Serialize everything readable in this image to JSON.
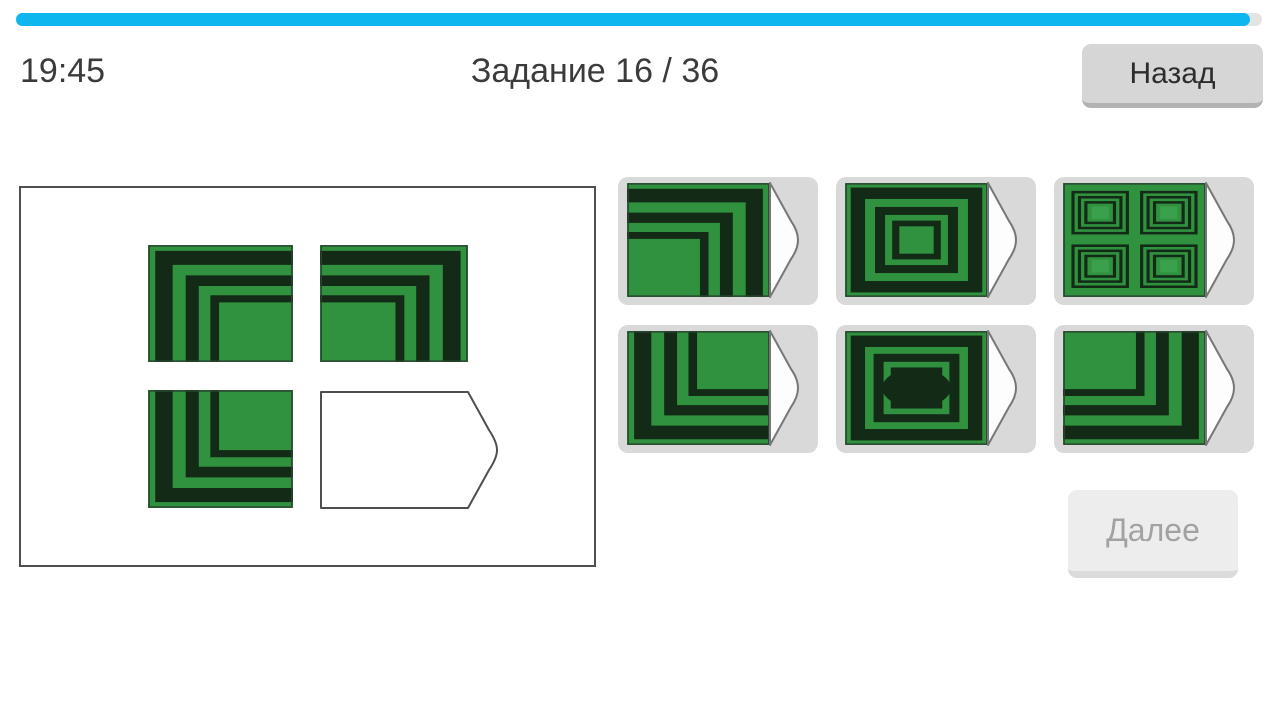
{
  "progress": {
    "percent_filled": 99,
    "fill_color": "#0db6ef",
    "track_color": "#e4e4e4"
  },
  "header": {
    "timer": "19:45",
    "title": "Задание 16 / 36"
  },
  "buttons": {
    "back": "Назад",
    "next": "Далее"
  },
  "palette": {
    "green": "#30913f",
    "green_light": "#3aa04b",
    "dark": "#122a16",
    "tile_outline": "#2a4630",
    "slot_outline": "#4f4f4f",
    "card_bg": "#d9d9d9"
  },
  "board": {
    "tiles": [
      {
        "cell": "top-left",
        "pattern": "corner-top-left"
      },
      {
        "cell": "top-right",
        "pattern": "corner-top-right"
      },
      {
        "cell": "bottom-left",
        "pattern": "corner-bottom-left"
      },
      {
        "cell": "bottom-right",
        "pattern": "empty-slot"
      }
    ],
    "bands": [
      [
        5,
        17
      ],
      [
        26,
        35
      ],
      [
        43,
        49
      ]
    ]
  },
  "options": [
    {
      "position": 1,
      "pattern": "corner-top-right"
    },
    {
      "position": 2,
      "pattern": "concentric-rects"
    },
    {
      "position": 3,
      "pattern": "quad-concentric-rects"
    },
    {
      "position": 4,
      "pattern": "corner-bottom-left"
    },
    {
      "position": 5,
      "pattern": "concentric-rects-ellipse"
    },
    {
      "position": 6,
      "pattern": "corner-bottom-right"
    }
  ],
  "figure_specs": {
    "concentric_frames": [
      [
        4,
        14
      ],
      [
        21,
        28
      ],
      [
        33,
        38
      ]
    ],
    "ellipse_frames": [
      [
        4,
        14
      ],
      [
        20,
        27
      ],
      [
        32,
        37
      ]
    ],
    "ellipse": {
      "rx": 24,
      "ry": 17
    },
    "quad_origins": [
      [
        7,
        8
      ],
      [
        55,
        8
      ],
      [
        7,
        55
      ],
      [
        55,
        55
      ]
    ],
    "quad_size": [
      38,
      36
    ],
    "quad_insets": [
      0,
      4.5,
      9
    ]
  }
}
